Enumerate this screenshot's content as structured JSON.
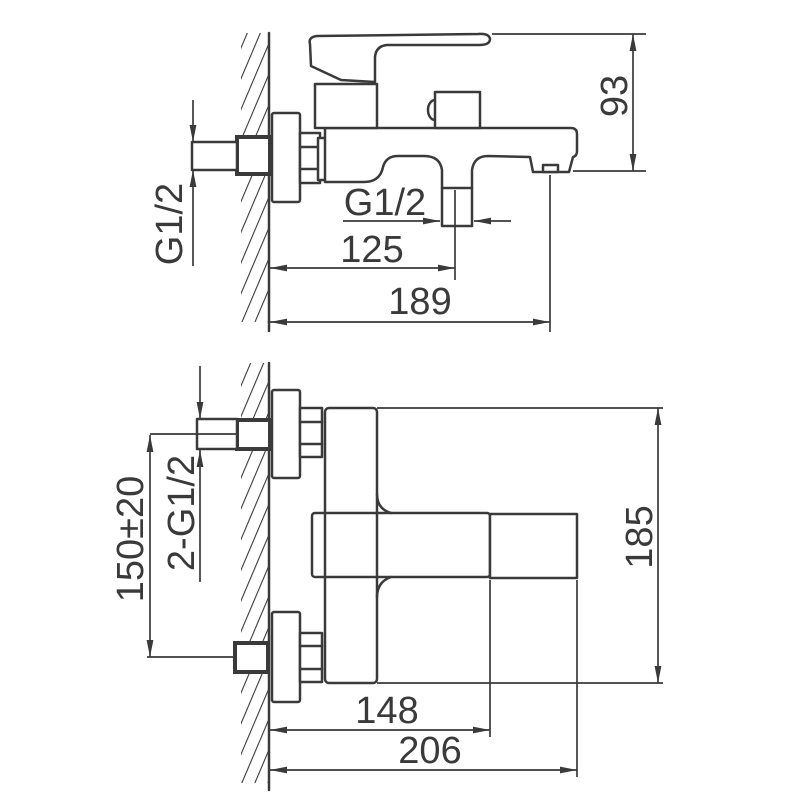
{
  "page": {
    "background": "#ffffff",
    "line_color": "#3a3a3a"
  },
  "side_view": {
    "dim_height": "93",
    "dim_inlet_thread": "G1/2",
    "dim_outlet_thread": "G1/2",
    "dim_wall_to_outlet": "125",
    "dim_wall_to_spout": "189"
  },
  "plan_view": {
    "dim_inlet_spacing": "150±20",
    "dim_inlet_threads": "2-G1/2",
    "dim_wall_to_body": "148",
    "dim_wall_to_handle": "206",
    "dim_overall_width": "185"
  }
}
